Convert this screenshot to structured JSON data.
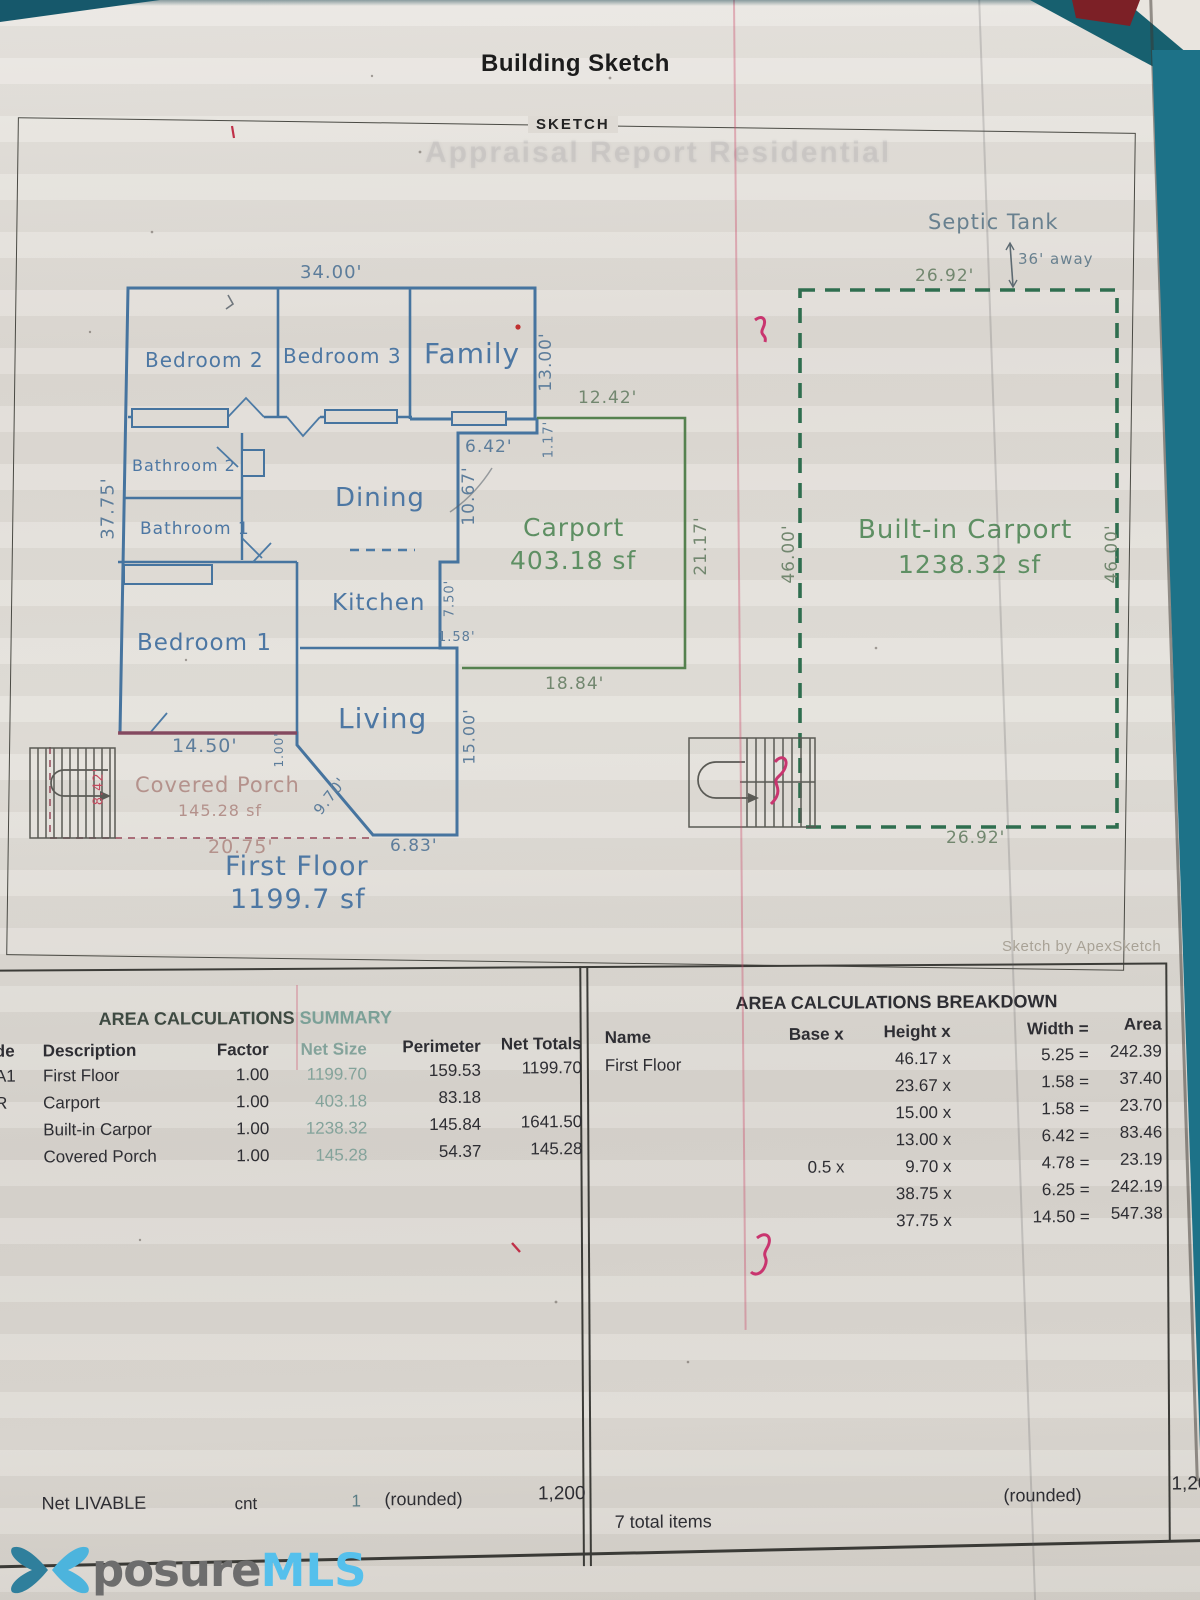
{
  "header": {
    "title": "Building Sketch",
    "sketch_label": "SKETCH",
    "ghost_title": "Appraisal Report Residential",
    "credit": "Sketch by ApexSketch"
  },
  "plan": {
    "rooms": {
      "bedroom2": "Bedroom 2",
      "bedroom3": "Bedroom 3",
      "family": "Family",
      "bathroom2": "Bathroom 2",
      "bathroom1": "Bathroom 1",
      "dining": "Dining",
      "kitchen": "Kitchen",
      "bedroom1": "Bedroom 1",
      "living": "Living"
    },
    "areas": {
      "first_floor_name": "First Floor",
      "first_floor_area": "1199.7 sf",
      "carport_name": "Carport",
      "carport_area": "403.18 sf",
      "built_in_name": "Built-in Carport",
      "built_in_area": "1238.32 sf",
      "porch_name": "Covered Porch",
      "porch_area": "145.28 sf"
    },
    "septic": {
      "name": "Septic Tank",
      "distance": "36' away"
    },
    "dims": {
      "d34": "34.00'",
      "d3775": "37.75'",
      "d13": "13.00'",
      "d117": "1.17'",
      "d1242": "12.42'",
      "d642": "6.42'",
      "d1067": "10.67'",
      "d2117": "21.17'",
      "d750": "7.50'",
      "d158": "1.58'",
      "d1500": "15.00'",
      "d1884": "18.84'",
      "d1450": "14.50'",
      "d100": "1.00'",
      "d970": "9.70'",
      "d683": "6.83'",
      "d2075": "20.75'",
      "d842": "8.42'",
      "d2692top": "26.92'",
      "d2692bot": "26.92'",
      "d46l": "46.00'",
      "d46r": "46.00'"
    }
  },
  "summary": {
    "title_main": "AREA CALCULATIONS",
    "title_accent": "SUMMARY",
    "headers": {
      "code": "de",
      "desc": "Description",
      "factor": "Factor",
      "net_size": "Net Size",
      "perimeter": "Perimeter",
      "net_totals": "Net Totals"
    },
    "rows": [
      {
        "code": "A1",
        "desc": "First Floor",
        "factor": "1.00",
        "net_size": "1199.70",
        "perimeter": "159.53",
        "net_totals": "1199.70"
      },
      {
        "code": "R",
        "desc": "Carport",
        "factor": "1.00",
        "net_size": "403.18",
        "perimeter": "83.18",
        "net_totals": ""
      },
      {
        "code": "",
        "desc": "Built-in Carpor",
        "factor": "1.00",
        "net_size": "1238.32",
        "perimeter": "145.84",
        "net_totals": "1641.50"
      },
      {
        "code": "",
        "desc": "Covered Porch",
        "factor": "1.00",
        "net_size": "145.28",
        "perimeter": "54.37",
        "net_totals": "145.28"
      }
    ],
    "footer": {
      "label": "Net LIVABLE",
      "cnt": "cnt",
      "count": "1",
      "rounded": "(rounded)",
      "total": "1,200"
    }
  },
  "breakdown": {
    "title": "AREA CALCULATIONS BREAKDOWN",
    "headers": {
      "name": "Name",
      "base": "Base x",
      "height": "Height x",
      "width": "Width =",
      "area": "Area"
    },
    "first_name": "First Floor",
    "rows": [
      {
        "base": "",
        "height": "46.17 x",
        "width": "5.25 =",
        "area": "242.39"
      },
      {
        "base": "",
        "height": "23.67 x",
        "width": "1.58 =",
        "area": "37.40"
      },
      {
        "base": "",
        "height": "15.00 x",
        "width": "1.58 =",
        "area": "23.70"
      },
      {
        "base": "",
        "height": "13.00 x",
        "width": "6.42 =",
        "area": "83.46"
      },
      {
        "base": "0.5 x",
        "height": "9.70 x",
        "width": "4.78 =",
        "area": "23.19"
      },
      {
        "base": "",
        "height": "38.75 x",
        "width": "6.25 =",
        "area": "242.19"
      },
      {
        "base": "",
        "height": "37.75 x",
        "width": "14.50 =",
        "area": "547.38"
      }
    ],
    "footer": {
      "items": "7 total items",
      "rounded": "(rounded)",
      "total": "1,20"
    }
  },
  "logo": {
    "part1": "posure",
    "part2": "MLS"
  }
}
